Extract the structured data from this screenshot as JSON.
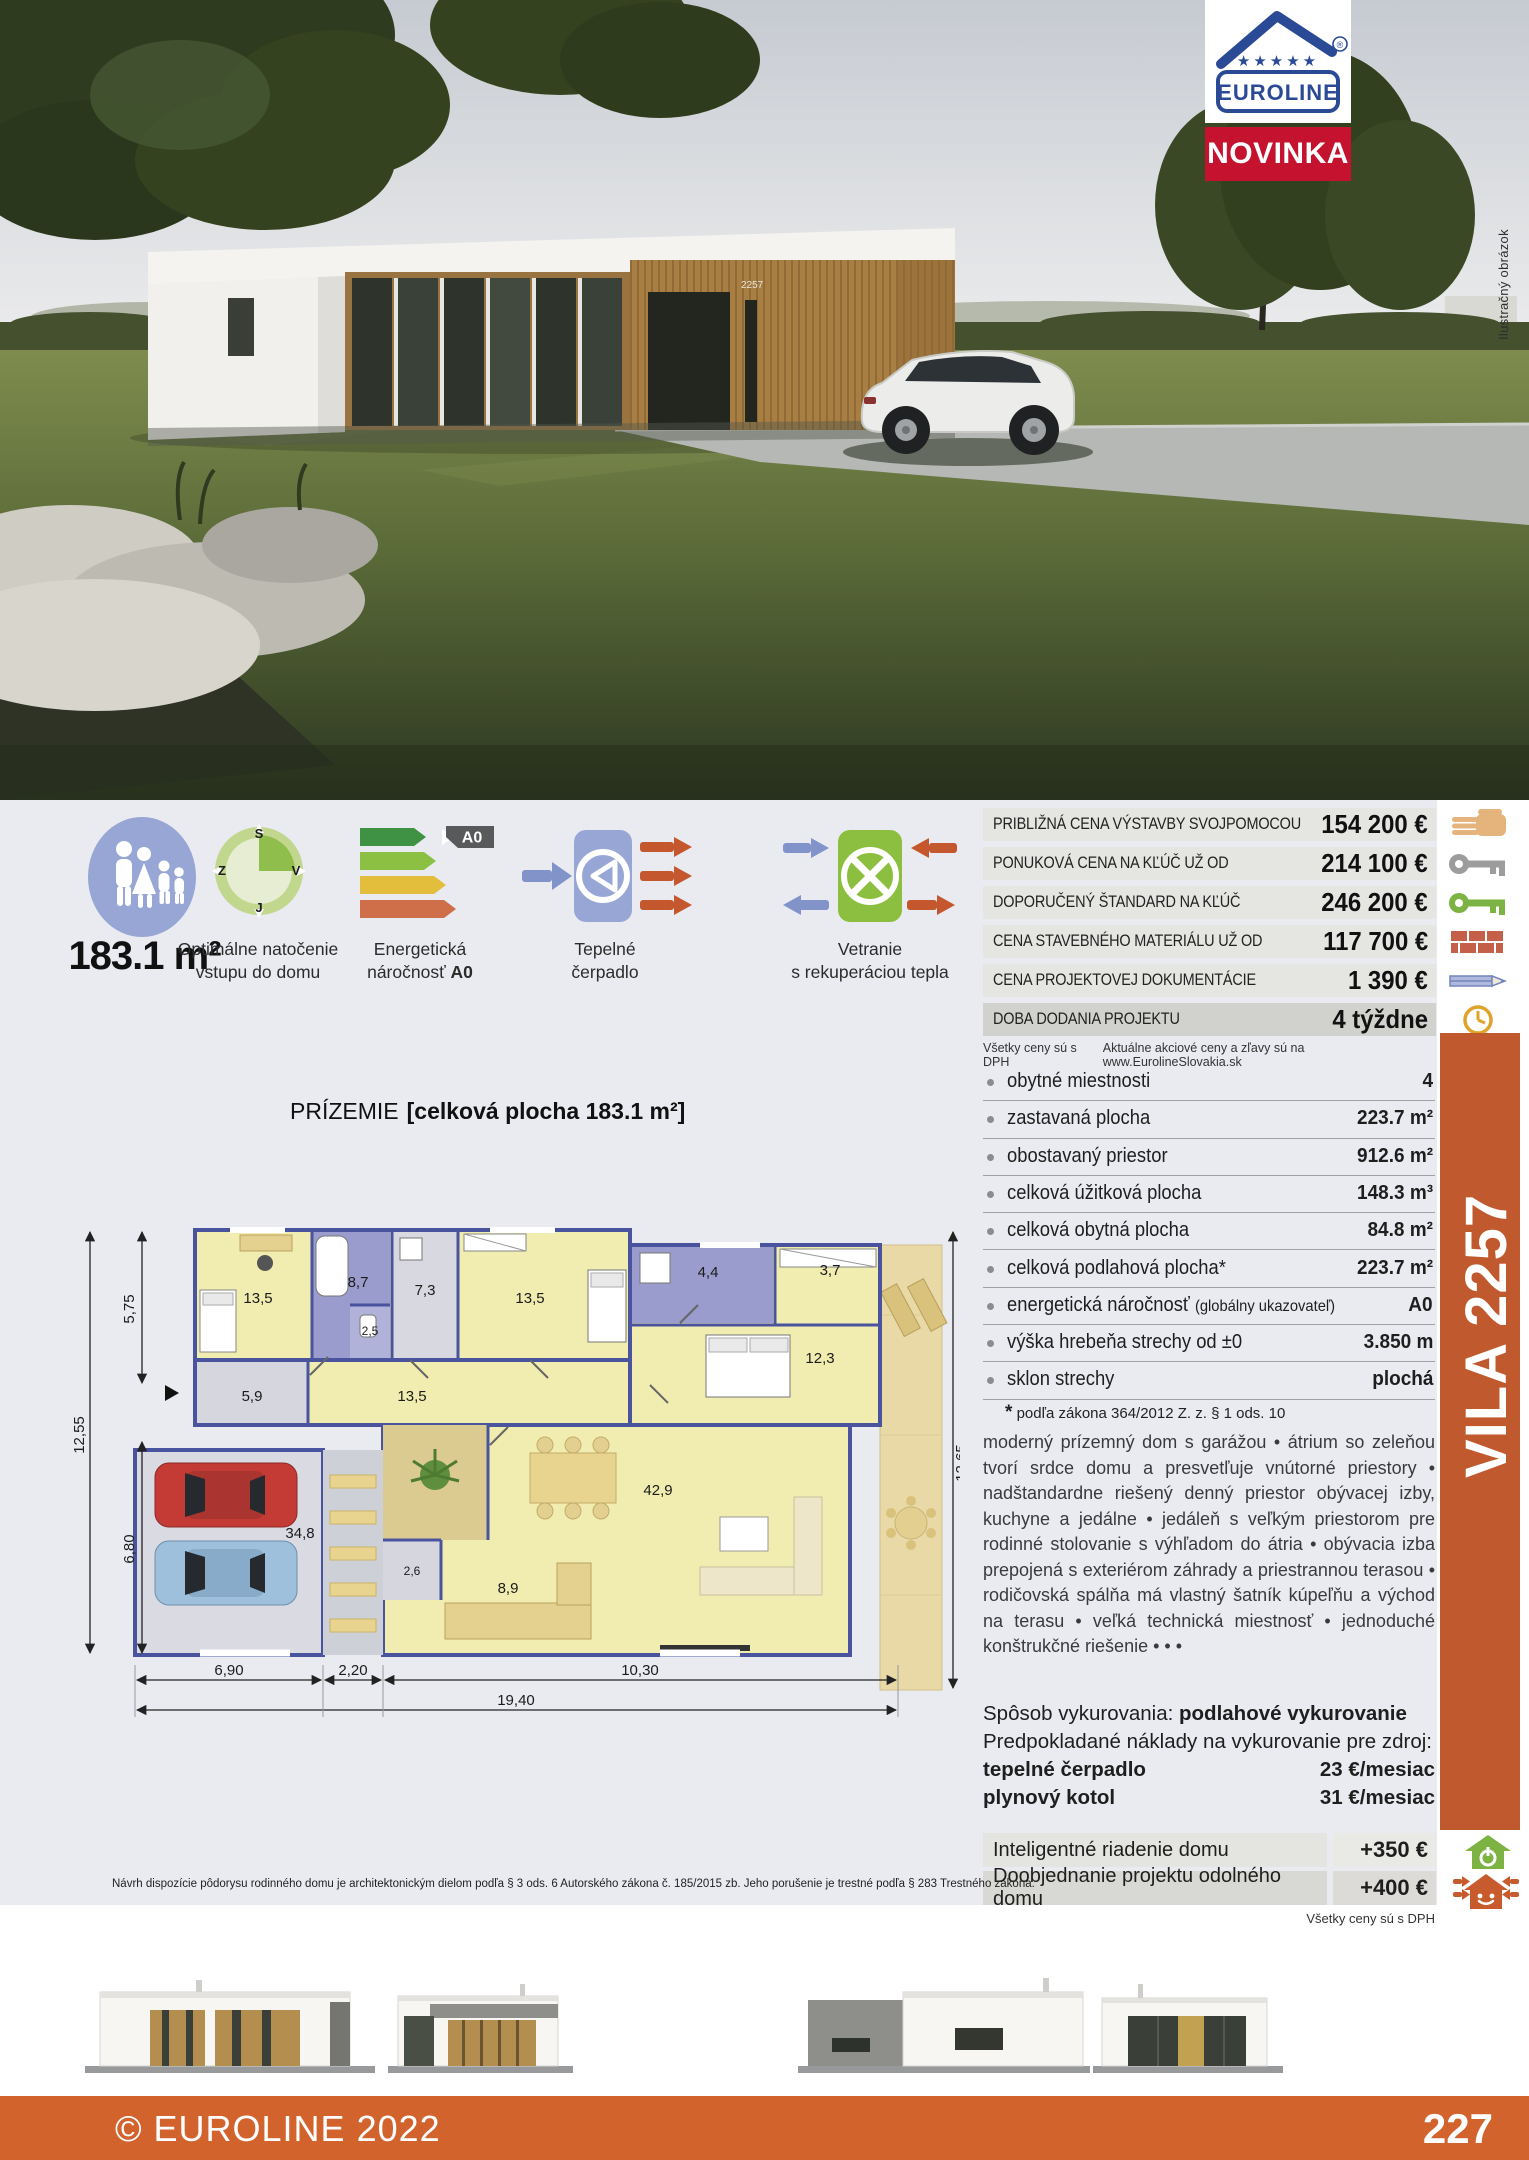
{
  "brand": {
    "logo_text": "EUROLINE",
    "registered": "®",
    "stars": "★★★★★",
    "badge": "NOVINKA",
    "model": "VILA 2257"
  },
  "photo": {
    "caption": "Ilustračný obrázok",
    "house_number": "2257"
  },
  "features": {
    "area": "183.1 m²",
    "orientation": {
      "line1": "Optimálne natočenie",
      "line2": "vstupu do domu",
      "compass": {
        "n": "S",
        "w": "Z",
        "e": "V",
        "s": "J"
      }
    },
    "energy": {
      "line1": "Energetická",
      "line2_prefix": "náročnosť ",
      "badge": "A0"
    },
    "heatpump": {
      "line1": "Tepelné",
      "line2": "čerpadlo"
    },
    "ventilation": {
      "line1": "Vetranie",
      "line2": "s rekuperáciou tepla"
    }
  },
  "prices": {
    "rows": [
      {
        "label": "PRIBLIŽNÁ CENA VÝSTAVBY SVOJPOMOCOU",
        "value": "154 200 €",
        "icon": "hand-icon"
      },
      {
        "label": "PONUKOVÁ CENA NA KĽÚČ UŽ OD",
        "value": "214 100 €",
        "icon": "key-gray-icon"
      },
      {
        "label": "DOPORUČENÝ ŠTANDARD NA KĽÚČ",
        "value": "246 200 €",
        "icon": "key-green-icon"
      },
      {
        "label": "CENA STAVEBNÉHO MATERIÁLU UŽ OD",
        "value": "117 700 €",
        "icon": "bricks-icon"
      },
      {
        "label": "CENA PROJEKTOVEJ DOKUMENTÁCIE",
        "value": "1 390 €",
        "icon": "pencil-icon"
      },
      {
        "label": "DOBA DODANIA PROJEKTU",
        "value": "4 týždne",
        "icon": "clock-icon"
      }
    ],
    "vat_note": "Všetky ceny sú s DPH",
    "promo_note": "Aktuálne akciové ceny a zľavy sú na www.EurolineSlovakia.sk"
  },
  "specs": {
    "rows": [
      {
        "label": "obytné miestnosti",
        "value": "4"
      },
      {
        "label": "zastavaná plocha",
        "value": "223.7 m²"
      },
      {
        "label": "obostavaný priestor",
        "value": "912.6 m²"
      },
      {
        "label": "celková úžitková plocha",
        "value": "148.3 m³"
      },
      {
        "label": "celková obytná plocha",
        "value": "84.8 m²"
      },
      {
        "label": "celková podlahová plocha*",
        "value": "223.7 m²"
      },
      {
        "label": "energetická náročnosť",
        "label_small": "(globálny ukazovateľ)",
        "value": "A0"
      },
      {
        "label": "výška hrebeňa strechy od ±0",
        "value": "3.850 m"
      },
      {
        "label": "sklon strechy",
        "value": "plochá"
      }
    ],
    "footnote_star": "*",
    "footnote": "podľa zákona 364/2012 Z. z. § 1 ods. 10"
  },
  "description": {
    "text": "moderný prízemný dom s garážou • átrium so zeleňou tvorí srdce domu a presvetľuje vnútorné priestory • nadštandardne riešený denný priestor obývacej izby, kuchyne a jedálne • jedáleň s veľkým priestorom pre rodinné stolovanie s výhľadom do átria • obývacia izba prepojená s exteriérom záhrady a priestrannou terasou • rodičovská spálňa má vlastný šatník kúpeľňu a východ na terasu • veľká technická miestnosť • jednoduché konštrukčné riešenie • • •"
  },
  "heating": {
    "method_label": "Spôsob vykurovania:",
    "method_value": "podlahové vykurovanie",
    "costs_label": "Predpokladané náklady na vykurovanie pre zdroj:",
    "sources": [
      {
        "label": "tepelné čerpadlo",
        "value": "23 €/mesiac"
      },
      {
        "label": "plynový kotol",
        "value": "31 €/mesiac"
      }
    ]
  },
  "addons": {
    "rows": [
      {
        "label": "Inteligentné riadenie domu",
        "value": "+350 €",
        "icon": "smart-home-icon"
      },
      {
        "label": "Doobjednanie projektu odolného domu",
        "value": "+400 €",
        "icon": "resilient-home-icon"
      }
    ],
    "vat_note": "Všetky ceny sú s DPH"
  },
  "plan": {
    "title": "PRÍZEMIE",
    "subtitle": "[celková plocha 183.1 m²]",
    "dims": {
      "left_top": "5,75",
      "left_full": "12,55",
      "left_bottom": "6,80",
      "right": "12,65",
      "b1": "6,90",
      "b2": "2,20",
      "b3": "10,30",
      "total": "19,40"
    },
    "rooms": [
      "13,5",
      "8,7",
      "7,3",
      "13,5",
      "2,5",
      "5,9",
      "13,5",
      "4,4",
      "3,7",
      "12,3",
      "42,9",
      "34,8",
      "2,6",
      "8,9"
    ]
  },
  "footer": {
    "copyright": "© EUROLINE 2022",
    "page": "227"
  },
  "legal": "Návrh dispozície pôdorysu rodinného domu je architektonickým dielom podľa § 3 ods. 6 Autorského zákona č. 185/2015 zb. Jeho porušenie je trestné podľa § 283 Trestného zákona."
}
